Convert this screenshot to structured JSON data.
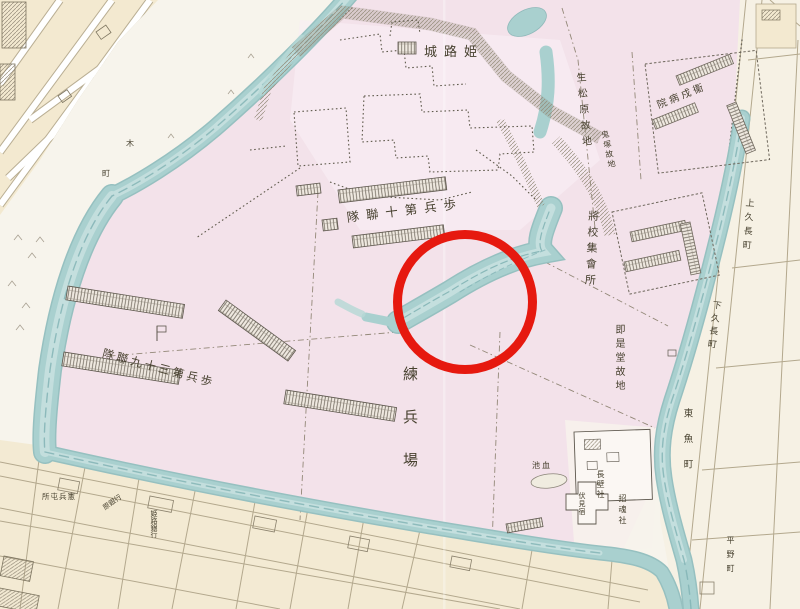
{
  "map": {
    "type": "historical-japanese-map",
    "description": "Scanned hand-colored map of the Himeji Castle army district with a red circle annotation over the inner moat",
    "colors": {
      "paper": "#f7f4ec",
      "district_cream": "#f3e9d0",
      "military_pink": "#f3e2ea",
      "moat_blue": "#a9d0cf",
      "moat_edge": "#8fb9ba",
      "ink": "#47412f",
      "annotation_red": "#e6190f"
    },
    "labels": {
      "castle": "城路姫",
      "infantry_10th": "隊聯十第兵歩",
      "infantry_39th": "隊聯九十三第兵歩",
      "officers_hall": "將校集會所",
      "garrison_hospital": "院病戍衞",
      "ikumatsubara_site": "生松原故地",
      "onizuka_site": "鬼塚故地",
      "parade_ground": "練兵場",
      "sokuzedo_site": "即是堂故地",
      "osakabe_shrine": "長壁社",
      "shokonsha_shrine": "招魂社",
      "fushimi_inn": "伏見宿",
      "pond": "池血",
      "kempei_post": "所屯兵憲",
      "bank": "原銀行",
      "himeji_bank": "姫路銀行",
      "kami_kunaga_cho": "上久長町",
      "shimo_kunaga_cho": "下久長町",
      "higashi_uomachi": "東魚町",
      "hirano_machi": "平野町",
      "char_ki": "木",
      "char_machi": "町"
    },
    "annotation": {
      "shape": "circle",
      "color": "#e6190f",
      "center_x": 465,
      "center_y": 302,
      "radius": 63
    }
  }
}
